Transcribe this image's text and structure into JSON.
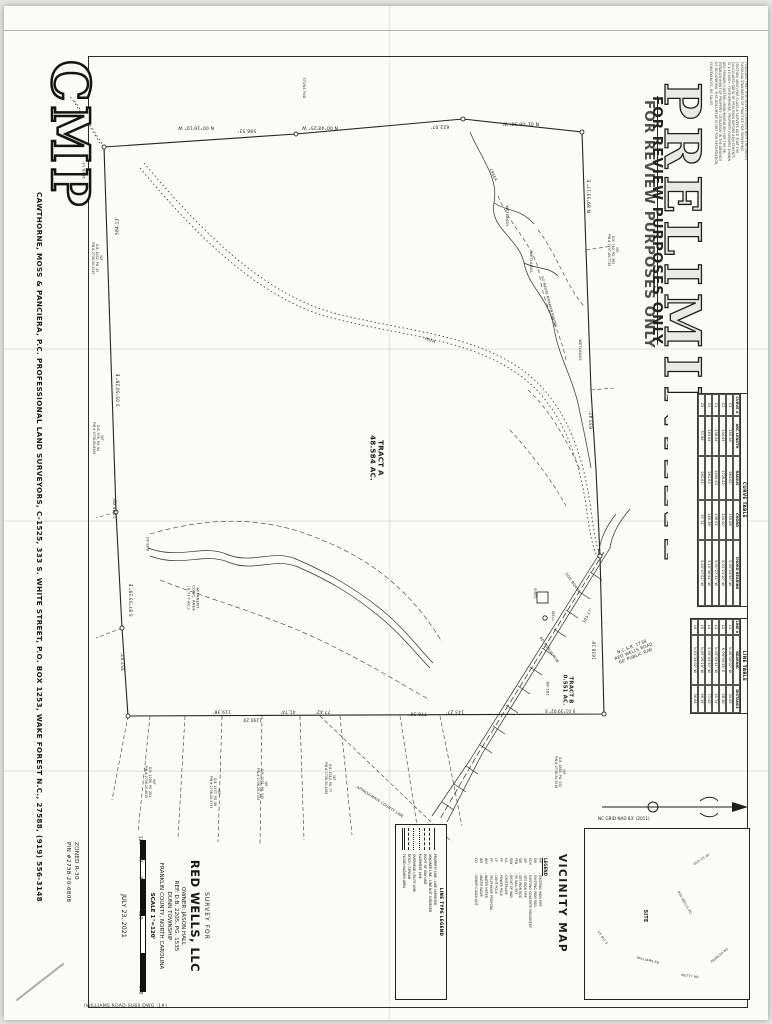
{
  "firm": {
    "logo": "CMP",
    "name_line": "CAWTHORNE, MOSS & PANCIERA, P.C.  PROFESSIONAL LAND SURVEYORS,  C-1525,  333 S. WHITE STREET,  P.O. BOX 1253,  WAKE FOREST N.C.,  27588,  (919) 556-3148"
  },
  "preliminary": {
    "word": "PRELIMINARY",
    "line1": "FOR REVIEW PURPOSES ONLY",
    "line2": "FOR REVIEW PURPOSES ONLY"
  },
  "declaration": {
    "lines": [
      "I DECLARE THAT THIS SURVEY COMPLIES WITH THE NORTH",
      "CAROLINA STANDARDS OF PRACTICE FOR SURVEYING",
      "(SECTION 1600) FOR CLASS A SURVEYS AND THAT THE",
      "CALCULATED RATIO OF PRECISION BEFORE ADJUSTMENTS",
      "IS 1:10,000+. FURTHERMORE, PROPERTY CORNERS SHOWN",
      "ARE PRIMARY CONTROL MONUMENTATION FOR THE RE-",
      "ESTABLISHMENT OF PROPERTY LITIGATION IN THE ABSENCE",
      "OF OCCUPATION. THIS DOCUMENT IS NOT FOR RECORDATION,",
      "CONVEYANCES, OR SALES."
    ]
  },
  "title_block": {
    "survey_for": "SURVEY FOR",
    "client": "RED WELLS, LLC",
    "owner": "OWNER: JASON HALL",
    "ref": "REF: D.B. 2205, PG. 1535",
    "township": "DUNN TOWNSHIP",
    "county": "FRANKLIN COUNTY, NORTH CAROLINA",
    "scale": "SCALE  1\"=120'",
    "date": "JULY 23, 2021"
  },
  "scale_bar": {
    "ticks": [
      {
        "t": "120",
        "x": 0
      },
      {
        "t": "60",
        "x": 19
      },
      {
        "t": "0",
        "x": 38
      },
      {
        "t": "120",
        "x": 75
      },
      {
        "t": "360",
        "x": 150
      }
    ]
  },
  "zoning": {
    "zoned": "ZONED R-30",
    "pin": "PIN #2738-20-6808"
  },
  "file_note": "(WILLIAMS ROAD-SU60.DWG -1#)",
  "plat": {
    "labels": [
      {
        "text": "N 00°16'10\" W",
        "x": 196,
        "y": 127,
        "r": 180,
        "fs": 4.5
      },
      {
        "text": "588.53'",
        "x": 247,
        "y": 130,
        "r": 180,
        "fs": 4.5
      },
      {
        "text": "N 00°48'25\" W",
        "x": 320,
        "y": 127,
        "r": 180,
        "fs": 4.5
      },
      {
        "text": "622.07'",
        "x": 440,
        "y": 126,
        "r": 180,
        "fs": 4.5
      },
      {
        "text": "N 01°06'38\" W",
        "x": 521,
        "y": 123,
        "r": 180,
        "fs": 4.5
      },
      {
        "text": "1658.11'",
        "x": 84,
        "y": 170,
        "r": -90,
        "fs": 3.8
      },
      {
        "text": "584.13'",
        "x": 118,
        "y": 226,
        "r": -90,
        "fs": 4.4
      },
      {
        "text": "S 05°50'29\" E",
        "x": 119,
        "y": 390,
        "r": -90,
        "fs": 4.4
      },
      {
        "text": "1095.95'",
        "x": 116,
        "y": 508,
        "r": -90,
        "fs": 4.4
      },
      {
        "text": "845.62'",
        "x": 148,
        "y": 543,
        "r": -90,
        "fs": 3.8
      },
      {
        "text": "S 87°55'29\" E",
        "x": 132,
        "y": 600,
        "r": -90,
        "fs": 4.4
      },
      {
        "text": "352.07'",
        "x": 124,
        "y": 662,
        "r": -90,
        "fs": 4.4
      },
      {
        "text": "1299.29'",
        "x": 252,
        "y": 719,
        "r": 180,
        "fs": 4
      },
      {
        "text": "119.38'",
        "x": 222,
        "y": 711,
        "r": 180,
        "fs": 4.4
      },
      {
        "text": "41.74'",
        "x": 288,
        "y": 711,
        "r": 180,
        "fs": 4.4
      },
      {
        "text": "77.42'",
        "x": 323,
        "y": 711,
        "r": 180,
        "fs": 4.4
      },
      {
        "text": "778.38'",
        "x": 418,
        "y": 713,
        "r": 180,
        "fs": 4.4
      },
      {
        "text": "143.27'",
        "x": 455,
        "y": 711,
        "r": 180,
        "fs": 4.4
      },
      {
        "text": "S 01°39'02\" E",
        "x": 560,
        "y": 710,
        "r": 180,
        "fs": 4
      },
      {
        "text": "181.68'",
        "x": 548,
        "y": 688,
        "r": -90,
        "fs": 3.8
      },
      {
        "text": "1638.16'",
        "x": 595,
        "y": 650,
        "r": -90,
        "fs": 4
      },
      {
        "text": "303.17'",
        "x": 588,
        "y": 616,
        "r": -62,
        "fs": 4
      },
      {
        "text": "N 89°53'17\" E",
        "x": 590,
        "y": 196,
        "r": -90,
        "fs": 4.4
      },
      {
        "text": "633.42'",
        "x": 592,
        "y": 420,
        "r": -90,
        "fs": 4.4
      },
      {
        "text": "TRACT A\n48.584 AC.",
        "x": 376,
        "y": 458,
        "r": 90,
        "fs": 7.2,
        "b": 1
      },
      {
        "text": "TRACT B\n0.551 AC.",
        "x": 567,
        "y": 690,
        "r": 90,
        "fs": 5.4,
        "b": 1
      },
      {
        "text": "PATH",
        "x": 430,
        "y": 341,
        "r": 20,
        "fs": 4
      },
      {
        "text": "CREEK",
        "x": 493,
        "y": 175,
        "r": 65,
        "fs": 3.7
      },
      {
        "text": "WETLANDS",
        "x": 507,
        "y": 216,
        "r": 90,
        "fs": 3.5
      },
      {
        "text": "WETLANDS",
        "x": 531,
        "y": 262,
        "r": 90,
        "fs": 3.5
      },
      {
        "text": "WETLANDS",
        "x": 580,
        "y": 350,
        "r": 90,
        "fs": 3.5
      },
      {
        "text": "50' NEUSE RIPARIAN BUFFER",
        "x": 548,
        "y": 302,
        "r": 75,
        "fs": 3.3
      },
      {
        "text": "APPARENT\nCONC. AREA\n(0.717 AC.)",
        "x": 193,
        "y": 598,
        "r": 90,
        "fs": 3.8
      },
      {
        "text": "WELL",
        "x": 553,
        "y": 616,
        "r": 90,
        "fs": 3.4
      },
      {
        "text": "SHED",
        "x": 535,
        "y": 593,
        "r": 90,
        "fs": 3.4
      },
      {
        "text": "N.C.S.R. 1738\nRED WELLS ROAD\n60' PUBLIC R/W",
        "x": 634,
        "y": 652,
        "r": -22,
        "fs": 4.2
      },
      {
        "text": "60' PUBLIC R/W",
        "x": 549,
        "y": 650,
        "r": 55,
        "fs": 3.6
      },
      {
        "text": "SOIL ROAD",
        "x": 572,
        "y": 582,
        "r": 55,
        "fs": 3.6
      },
      {
        "text": "STONE FND",
        "x": 303,
        "y": 88,
        "r": 90,
        "fs": 3.3
      },
      {
        "text": "APPROXIMATE COUNTY LINE",
        "x": 380,
        "y": 802,
        "r": 33,
        "fs": 3.6
      }
    ],
    "adjoiners": [
      {
        "text": "N/F\nD.B. 1042, PG. 15\nPIN # 2738-10-2215",
        "x": 97,
        "y": 258,
        "r": 90
      },
      {
        "text": "N/F\nD.B. 978, PG. 64\nPIN # 2738-00-8149",
        "x": 98,
        "y": 438,
        "r": 90
      },
      {
        "text": "N/F\nD.B. 760, PG. 363\nPIN # 2737-89-7739",
        "x": 613,
        "y": 250,
        "r": 90
      },
      {
        "text": "N/F\nD.B. 1286, PG. 201\nPIN # 2738-20-0815",
        "x": 150,
        "y": 782,
        "r": 90
      },
      {
        "text": "N/F\nD.B. 1457, PG. 88\nPIN # 2738-20-1733",
        "x": 215,
        "y": 792,
        "r": 90
      },
      {
        "text": "N/F\nD.B. 2031, PG. 540\nPIN # 2738-20-3704",
        "x": 262,
        "y": 784,
        "r": 90
      },
      {
        "text": "N/F\nD.B. 1910, PG. 77\nPIN # 2738-30-1269",
        "x": 330,
        "y": 778,
        "r": 90
      },
      {
        "text": "N/F\nD.B. 1685, PG. 332\nPIN # 2738-30-3318",
        "x": 560,
        "y": 772,
        "r": 90
      }
    ]
  },
  "curve_table": {
    "title": "CURVE TABLE",
    "columns": [
      "CURVE #",
      "ARC LENGTH",
      "RADIUS",
      "CHORD",
      "CHORD BEARING"
    ],
    "rows": [
      [
        "C1",
        "155.18'",
        "963.62'",
        "155.08'",
        "S 05°53'56\" W"
      ],
      [
        "C2",
        "144.44'",
        "1726.42'",
        "144.40'",
        "S 03°21'10\" W"
      ],
      [
        "C3",
        "138.04'",
        "1694.43'",
        "138.01'",
        "S 01°27'31\" W"
      ],
      [
        "C4",
        "163.04'",
        "261.63'",
        "160.38'",
        "S 16°36'44\" W"
      ],
      [
        "C5",
        "57.84'",
        "261.63'",
        "57.72'",
        "S 40°47'02\" W"
      ]
    ]
  },
  "line_table": {
    "title": "LINE TABLE",
    "columns": [
      "LINE #",
      "BEARING",
      "DISTANCE"
    ],
    "rows": [
      [
        "L1",
        "N 40°10'02\" W",
        "34.05'"
      ],
      [
        "L2",
        "N 09°59'33\" E",
        "28.30'"
      ],
      [
        "L3",
        "N 45°43'41\" W",
        "41.74'"
      ],
      [
        "L4",
        "S 49°43'20\" W",
        "77.42'"
      ],
      [
        "L5",
        "N 05°29'19\" W",
        "66.15'"
      ],
      [
        "L6",
        "N 01°39'02\" W",
        "36.64'"
      ]
    ]
  },
  "legend": {
    "title": "LEGEND",
    "items": [
      {
        "k": "EIP",
        "v": "- EXISTING IRON PIPE"
      },
      {
        "k": "EIR",
        "v": "- EXISTING IRON ROD"
      },
      {
        "k": "ECM",
        "v": "- EXISTING CONCRETE MONUMENT"
      },
      {
        "k": "SIP",
        "v": "- SET IRON PIPE"
      },
      {
        "k": "SIR",
        "v": "- SET IRON ROD"
      },
      {
        "k": "PKN",
        "v": "- PK NAIL SET"
      },
      {
        "k": "R/W",
        "v": "- RIGHT OF WAY"
      },
      {
        "k": "C/L",
        "v": "- CENTERLINE"
      },
      {
        "k": "PP",
        "v": "- POWER POLE"
      },
      {
        "k": "LP",
        "v": "- LIGHT POLE"
      },
      {
        "k": "TP",
        "v": "- TELEPHONE PEDESTAL"
      },
      {
        "k": "WM",
        "v": "- WATER METER"
      },
      {
        "k": "WV",
        "v": "- WATER VALVE"
      },
      {
        "k": "CO",
        "v": "- SEWER CLEAN-OUT"
      }
    ]
  },
  "line_type_legend": {
    "title": "LINE TYPE LEGEND",
    "items": [
      {
        "s": "solid",
        "v": "PROPERTY LINE - LINE SURVEYED"
      },
      {
        "s": "dash",
        "v": "ADJOINER LINE - LINE NOT SURVEYED"
      },
      {
        "s": "dash",
        "v": "RIGHT OF WAY LINE"
      },
      {
        "s": "dot",
        "v": "EASEMENT LINE"
      },
      {
        "s": "dot",
        "v": "OVERHEAD UTILITY LINE"
      },
      {
        "s": "dash",
        "v": "DITCH / STREAM"
      },
      {
        "s": "dbl",
        "v": "FLOOD HAZARD AREA"
      }
    ]
  },
  "vicinity": {
    "title": "VICINITY MAP",
    "grid_note": "NC GRID NAD 83' (2011)",
    "labels": [
      {
        "text": "SITE",
        "x": 644,
        "y": 916,
        "r": 90,
        "fs": 5,
        "b": 1
      },
      {
        "text": "RED WELLS RD",
        "x": 684,
        "y": 903,
        "r": 60,
        "fs": 3.1
      },
      {
        "text": "WILLIAMS RD",
        "x": 648,
        "y": 961,
        "r": 14,
        "fs": 3.1
      },
      {
        "text": "NUTTY RD",
        "x": 690,
        "y": 977,
        "r": 8,
        "fs": 3.1
      },
      {
        "text": "PEARCES RD",
        "x": 720,
        "y": 956,
        "r": -40,
        "fs": 3.1
      },
      {
        "text": "OLD US 64",
        "x": 702,
        "y": 860,
        "r": -33,
        "fs": 3.1
      },
      {
        "text": "US 401 S",
        "x": 602,
        "y": 938,
        "r": 55,
        "fs": 3.1
      }
    ]
  }
}
